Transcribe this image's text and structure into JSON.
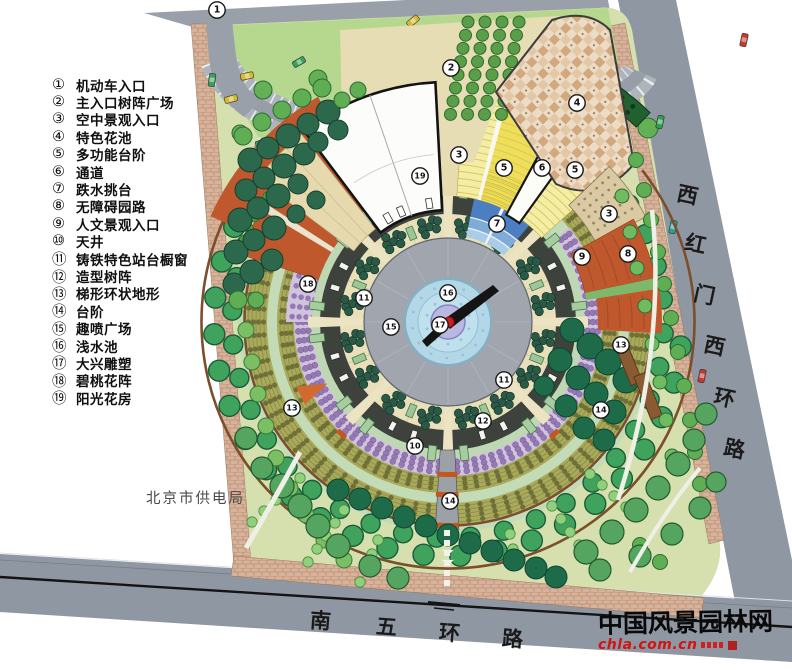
{
  "plan": {
    "legend": {
      "items": [
        {
          "num": "①",
          "label": "机动车入口"
        },
        {
          "num": "②",
          "label": "主入口树阵广场"
        },
        {
          "num": "③",
          "label": "空中景观入口"
        },
        {
          "num": "④",
          "label": "特色花池"
        },
        {
          "num": "⑤",
          "label": "多功能台阶"
        },
        {
          "num": "⑥",
          "label": "通道"
        },
        {
          "num": "⑦",
          "label": "跌水挑台"
        },
        {
          "num": "⑧",
          "label": "无障碍园路"
        },
        {
          "num": "⑨",
          "label": "人文景观入口"
        },
        {
          "num": "⑩",
          "label": "天井"
        },
        {
          "num": "⑪",
          "label": "铸铁特色站台橱窗"
        },
        {
          "num": "⑫",
          "label": "造型树阵"
        },
        {
          "num": "⑬",
          "label": "梯形环状地形"
        },
        {
          "num": "⑭",
          "label": "台阶"
        },
        {
          "num": "⑮",
          "label": "趣喷广场"
        },
        {
          "num": "⑯",
          "label": "浅水池"
        },
        {
          "num": "⑰",
          "label": "大兴雕塑"
        },
        {
          "num": "⑱",
          "label": "碧桃花阵"
        },
        {
          "num": "⑲",
          "label": "阳光花房"
        }
      ]
    },
    "roads": {
      "south_chars": [
        "南",
        "五",
        "环",
        "路"
      ],
      "east_chars": [
        "西",
        "红",
        "门",
        "西",
        "环",
        "路"
      ]
    },
    "annotations": {
      "power_bureau": "北京市供电局"
    },
    "watermark": {
      "title": "中国风景园林网",
      "url": "chla.com.cn"
    },
    "markers": [
      {
        "n": "1",
        "x": 217,
        "y": 10
      },
      {
        "n": "2",
        "x": 451,
        "y": 68
      },
      {
        "n": "3",
        "x": 459,
        "y": 155
      },
      {
        "n": "4",
        "x": 577,
        "y": 103
      },
      {
        "n": "5",
        "x": 504,
        "y": 168
      },
      {
        "n": "6",
        "x": 542,
        "y": 168
      },
      {
        "n": "5",
        "x": 575,
        "y": 170
      },
      {
        "n": "3",
        "x": 609,
        "y": 214
      },
      {
        "n": "9",
        "x": 582,
        "y": 257
      },
      {
        "n": "8",
        "x": 628,
        "y": 254
      },
      {
        "n": "7",
        "x": 497,
        "y": 224
      },
      {
        "n": "19",
        "x": 420,
        "y": 176
      },
      {
        "n": "18",
        "x": 308,
        "y": 284
      },
      {
        "n": "11",
        "x": 364,
        "y": 298
      },
      {
        "n": "16",
        "x": 448,
        "y": 293
      },
      {
        "n": "15",
        "x": 391,
        "y": 327
      },
      {
        "n": "17",
        "x": 440,
        "y": 325
      },
      {
        "n": "11",
        "x": 504,
        "y": 380
      },
      {
        "n": "13",
        "x": 621,
        "y": 345
      },
      {
        "n": "14",
        "x": 601,
        "y": 410
      },
      {
        "n": "12",
        "x": 483,
        "y": 421
      },
      {
        "n": "10",
        "x": 415,
        "y": 446
      },
      {
        "n": "13",
        "x": 292,
        "y": 408
      },
      {
        "n": "14",
        "x": 450,
        "y": 501
      }
    ],
    "colors": {
      "site_green": "#d6e0ae",
      "road_gray": "#8f97a2",
      "terracotta": "#c0582e",
      "pool_blue": "#b3d7e7",
      "olive_ring": "#a9aa5b",
      "purple_ring": "#9678b4",
      "tree_green": "#3fa35e",
      "step_yellow": "#f4eda6",
      "watermark_red": "#d01414"
    }
  }
}
